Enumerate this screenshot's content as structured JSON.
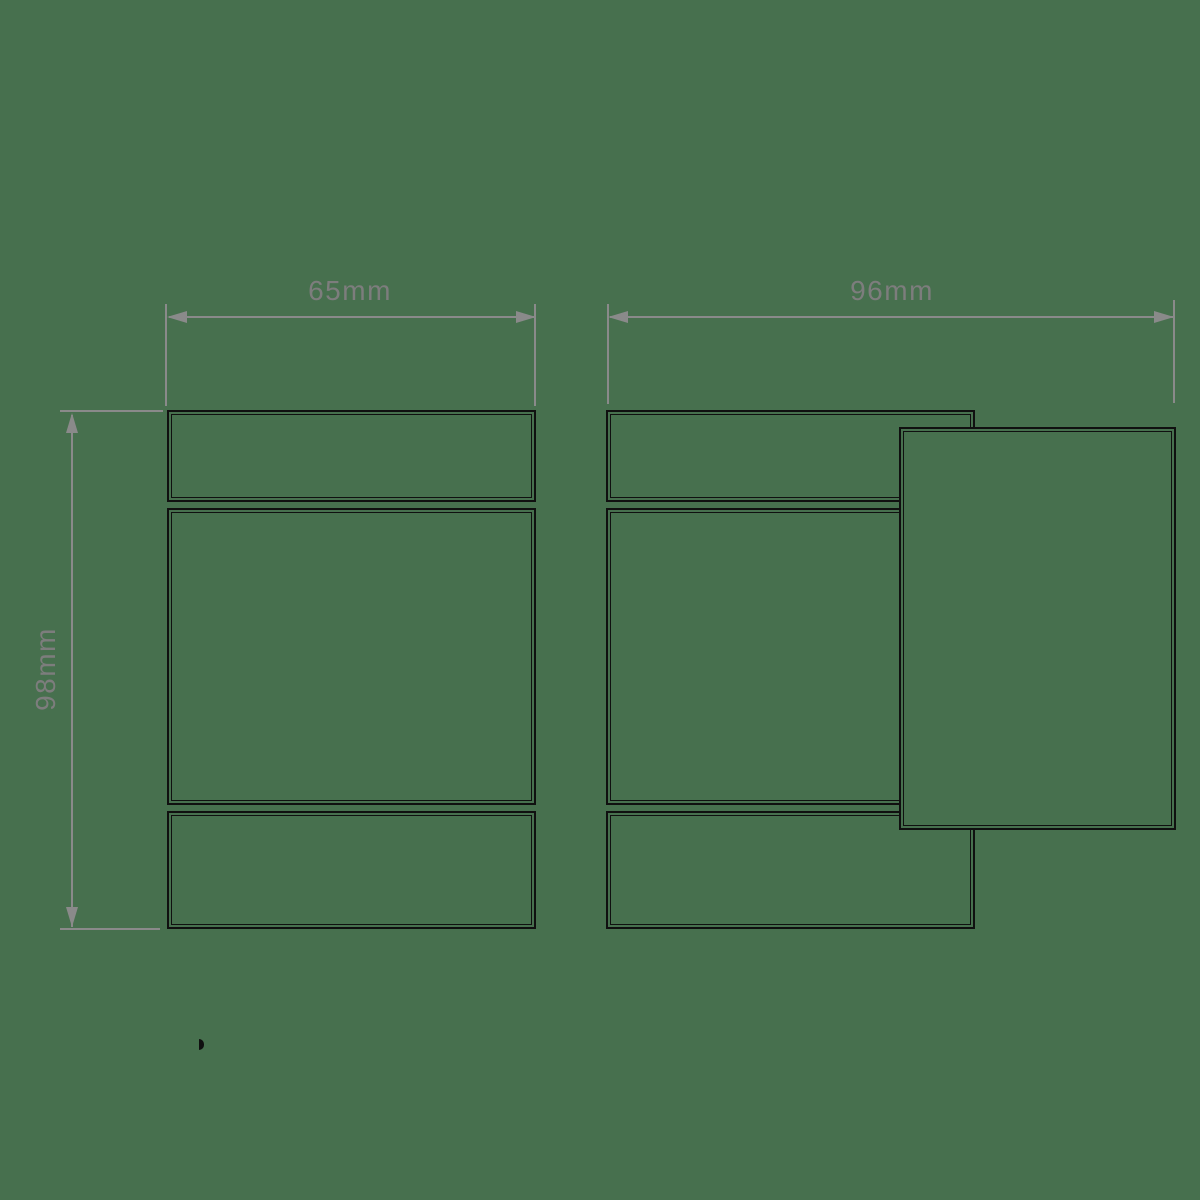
{
  "colors": {
    "background": "#47704e",
    "outline": "#101010",
    "dimension": "#8a8a8a",
    "label": "#7d7d7d"
  },
  "dimensions": {
    "front_width": "65mm",
    "side_width": "96mm",
    "height": "98mm"
  }
}
